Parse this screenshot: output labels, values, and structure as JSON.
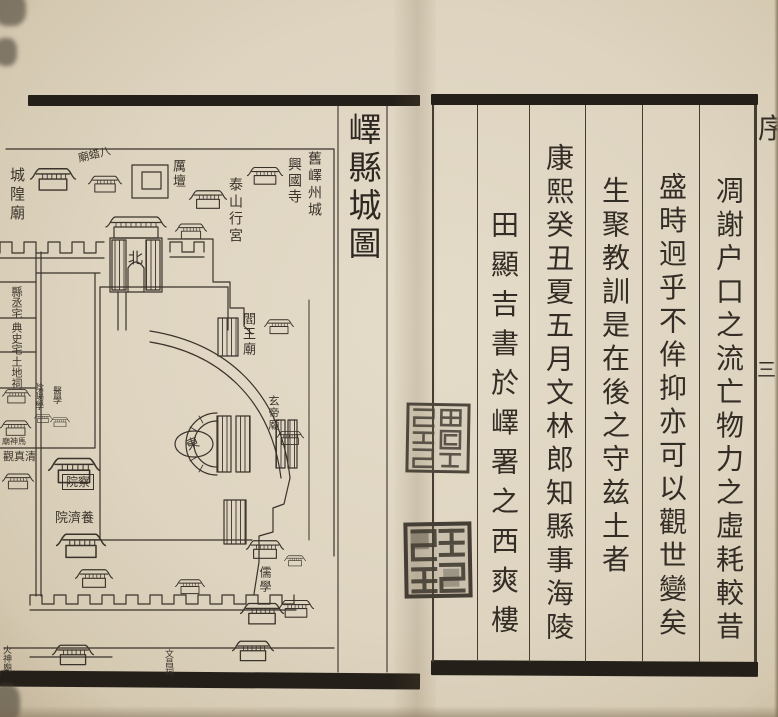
{
  "book": {
    "left_page": {
      "title": "嶧縣城圖",
      "labels": {
        "old_city": "舊嶧州城",
        "xingguo_temple": "興國寺",
        "taishan_palace": "泰山行宮",
        "li_altar": "厲壇",
        "bazha_temple": "八蜡廟",
        "chenghuang_temple": "城隍廟",
        "north_gate": "北",
        "yanwang_temple": "閻王廟",
        "xuandi_temple": "玄帝廟",
        "east_gate": "東",
        "county_deputy_residence": "縣丞宅",
        "dianshi_residence": "典史宅",
        "tudi_shrine": "土地祠",
        "yinyang_school": "陰陽學",
        "medical_school": "醫學",
        "mashen_temple": "馬神廟",
        "qingzhen_temple": "清真觀",
        "censorate_hostel": "察院",
        "almshouse": "養濟院",
        "confucian_school": "儒學",
        "huoshen_temple": "火神廟",
        "wenchang_shrine": "文昌祠"
      }
    },
    "right_page": {
      "columns": [
        {
          "text": "凋謝户口之流亡物力之虛耗較昔"
        },
        {
          "text": "盛時迥乎不侔抑亦可以觀世變矣"
        },
        {
          "text": "生聚教訓是在後之守兹土者"
        },
        {
          "text": "康熙癸丑夏五月文林郎知縣事海陵"
        },
        {
          "text": "田顯吉書於嶧署之西爽樓"
        }
      ],
      "edge": {
        "section_mark": "序",
        "leaf_number": "三"
      },
      "seals": [
        {
          "name": "upper seal"
        },
        {
          "name": "lower seal"
        }
      ]
    },
    "colors": {
      "ink": "#3a332b",
      "paper": "#ded4c0",
      "seal": "#4d463b"
    }
  }
}
